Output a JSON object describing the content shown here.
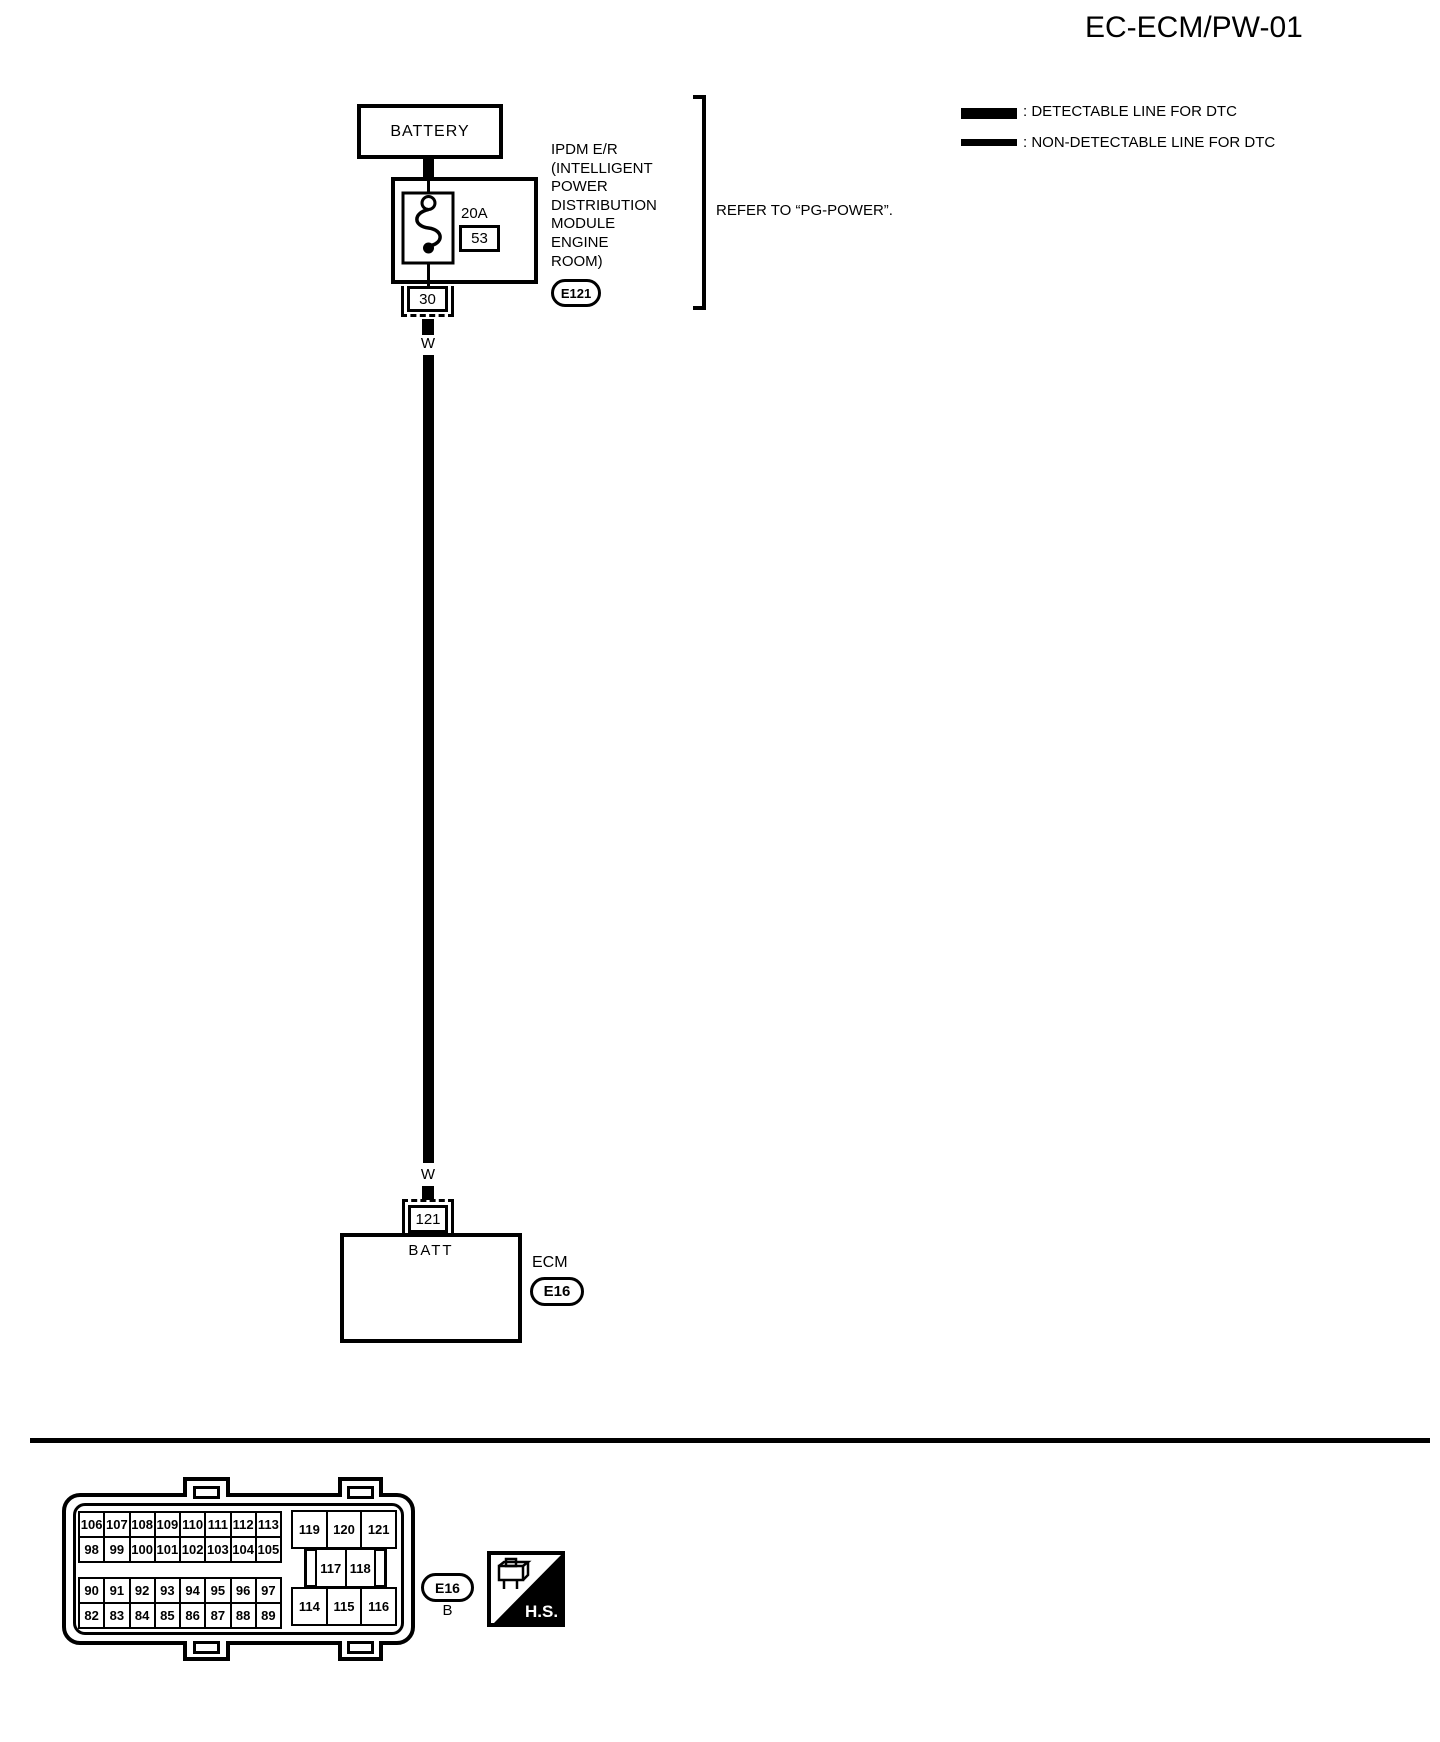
{
  "page": {
    "title": "EC-ECM/PW-01"
  },
  "legend": {
    "detectable": ": DETECTABLE LINE FOR DTC",
    "non_detectable": ": NON-DETECTABLE LINE FOR DTC"
  },
  "diagram": {
    "battery": "BATTERY",
    "fuse_rating": "20A",
    "fuse_number": "53",
    "ipdm_lines": [
      "IPDM E/R",
      "(INTELLIGENT",
      "POWER",
      "DISTRIBUTION",
      "MODULE",
      "ENGINE",
      "ROOM)"
    ],
    "ipdm_connector": "E121",
    "refer_note": "REFER TO “PG-POWER”.",
    "pin_top": "30",
    "wire_color_top": "W",
    "wire_color_bottom": "W",
    "pin_bottom": "121",
    "ecm_terminal": "BATT",
    "ecm_name": "ECM",
    "ecm_connector": "E16"
  },
  "connector_view": {
    "code": "E16",
    "color": "B",
    "hs": "H.S.",
    "tl_rows": [
      [
        "106",
        "107",
        "108",
        "109",
        "110",
        "111",
        "112",
        "113"
      ],
      [
        "98",
        "99",
        "100",
        "101",
        "102",
        "103",
        "104",
        "105"
      ]
    ],
    "bl_rows": [
      [
        "90",
        "91",
        "92",
        "93",
        "94",
        "95",
        "96",
        "97"
      ],
      [
        "82",
        "83",
        "84",
        "85",
        "86",
        "87",
        "88",
        "89"
      ]
    ],
    "right_top": [
      "119",
      "120",
      "121"
    ],
    "right_mid": [
      "117",
      "118"
    ],
    "right_bottom": [
      "114",
      "115",
      "116"
    ]
  }
}
